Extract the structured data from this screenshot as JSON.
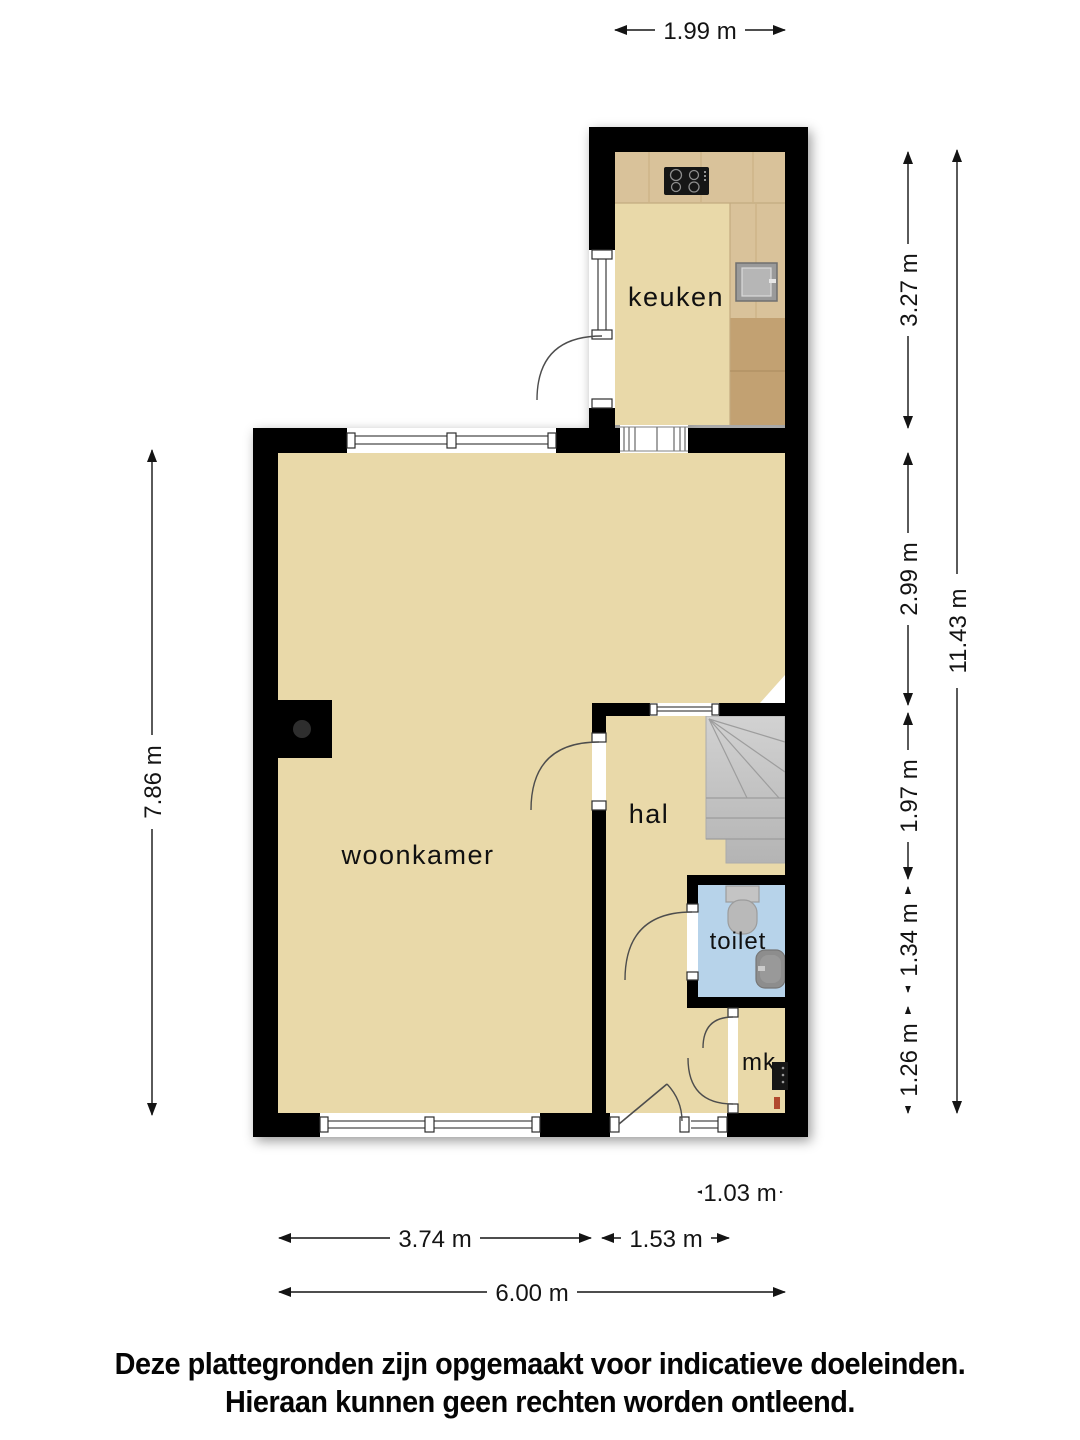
{
  "rooms": {
    "keuken": "keuken",
    "woonkamer": "woonkamer",
    "hal": "hal",
    "toilet": "toilet",
    "mk": "mk"
  },
  "dimensions": {
    "kitchen_width": "1.99 m",
    "kitchen_height": "3.27 m",
    "living_upper_height": "2.99 m",
    "hall_height": "1.97 m",
    "toilet_height": "1.34 m",
    "mk_height": "1.26 m",
    "total_height": "11.43 m",
    "living_height": "7.86 m",
    "toilet_width": "1.03 m",
    "living_width": "3.74 m",
    "hall_width": "1.53 m",
    "total_width": "6.00 m"
  },
  "disclaimer": {
    "line1": "Deze plattegronden zijn opgemaakt voor indicatieve doeleinden.",
    "line2": "Hieraan kunnen geen rechten worden ontleend."
  },
  "colors": {
    "wall": "#000000",
    "floor": "#e9d9a9",
    "toilet_floor": "#b7d3ea",
    "counter_light": "#d9c29a",
    "counter_dark": "#c2a172",
    "stairs_light": "#d0d0d0",
    "stairs_dark": "#b6b6b6"
  }
}
